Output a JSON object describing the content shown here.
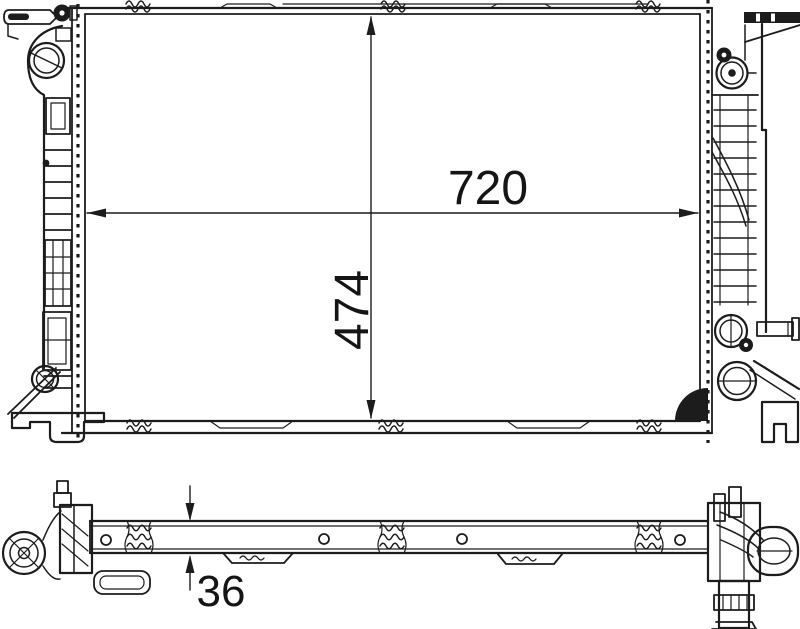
{
  "canvas": {
    "background": "#ffffff",
    "line_color": "#1c1c1c",
    "text_color": "#151515"
  },
  "dimensions": {
    "width": "720",
    "height": "474",
    "depth": "36"
  }
}
